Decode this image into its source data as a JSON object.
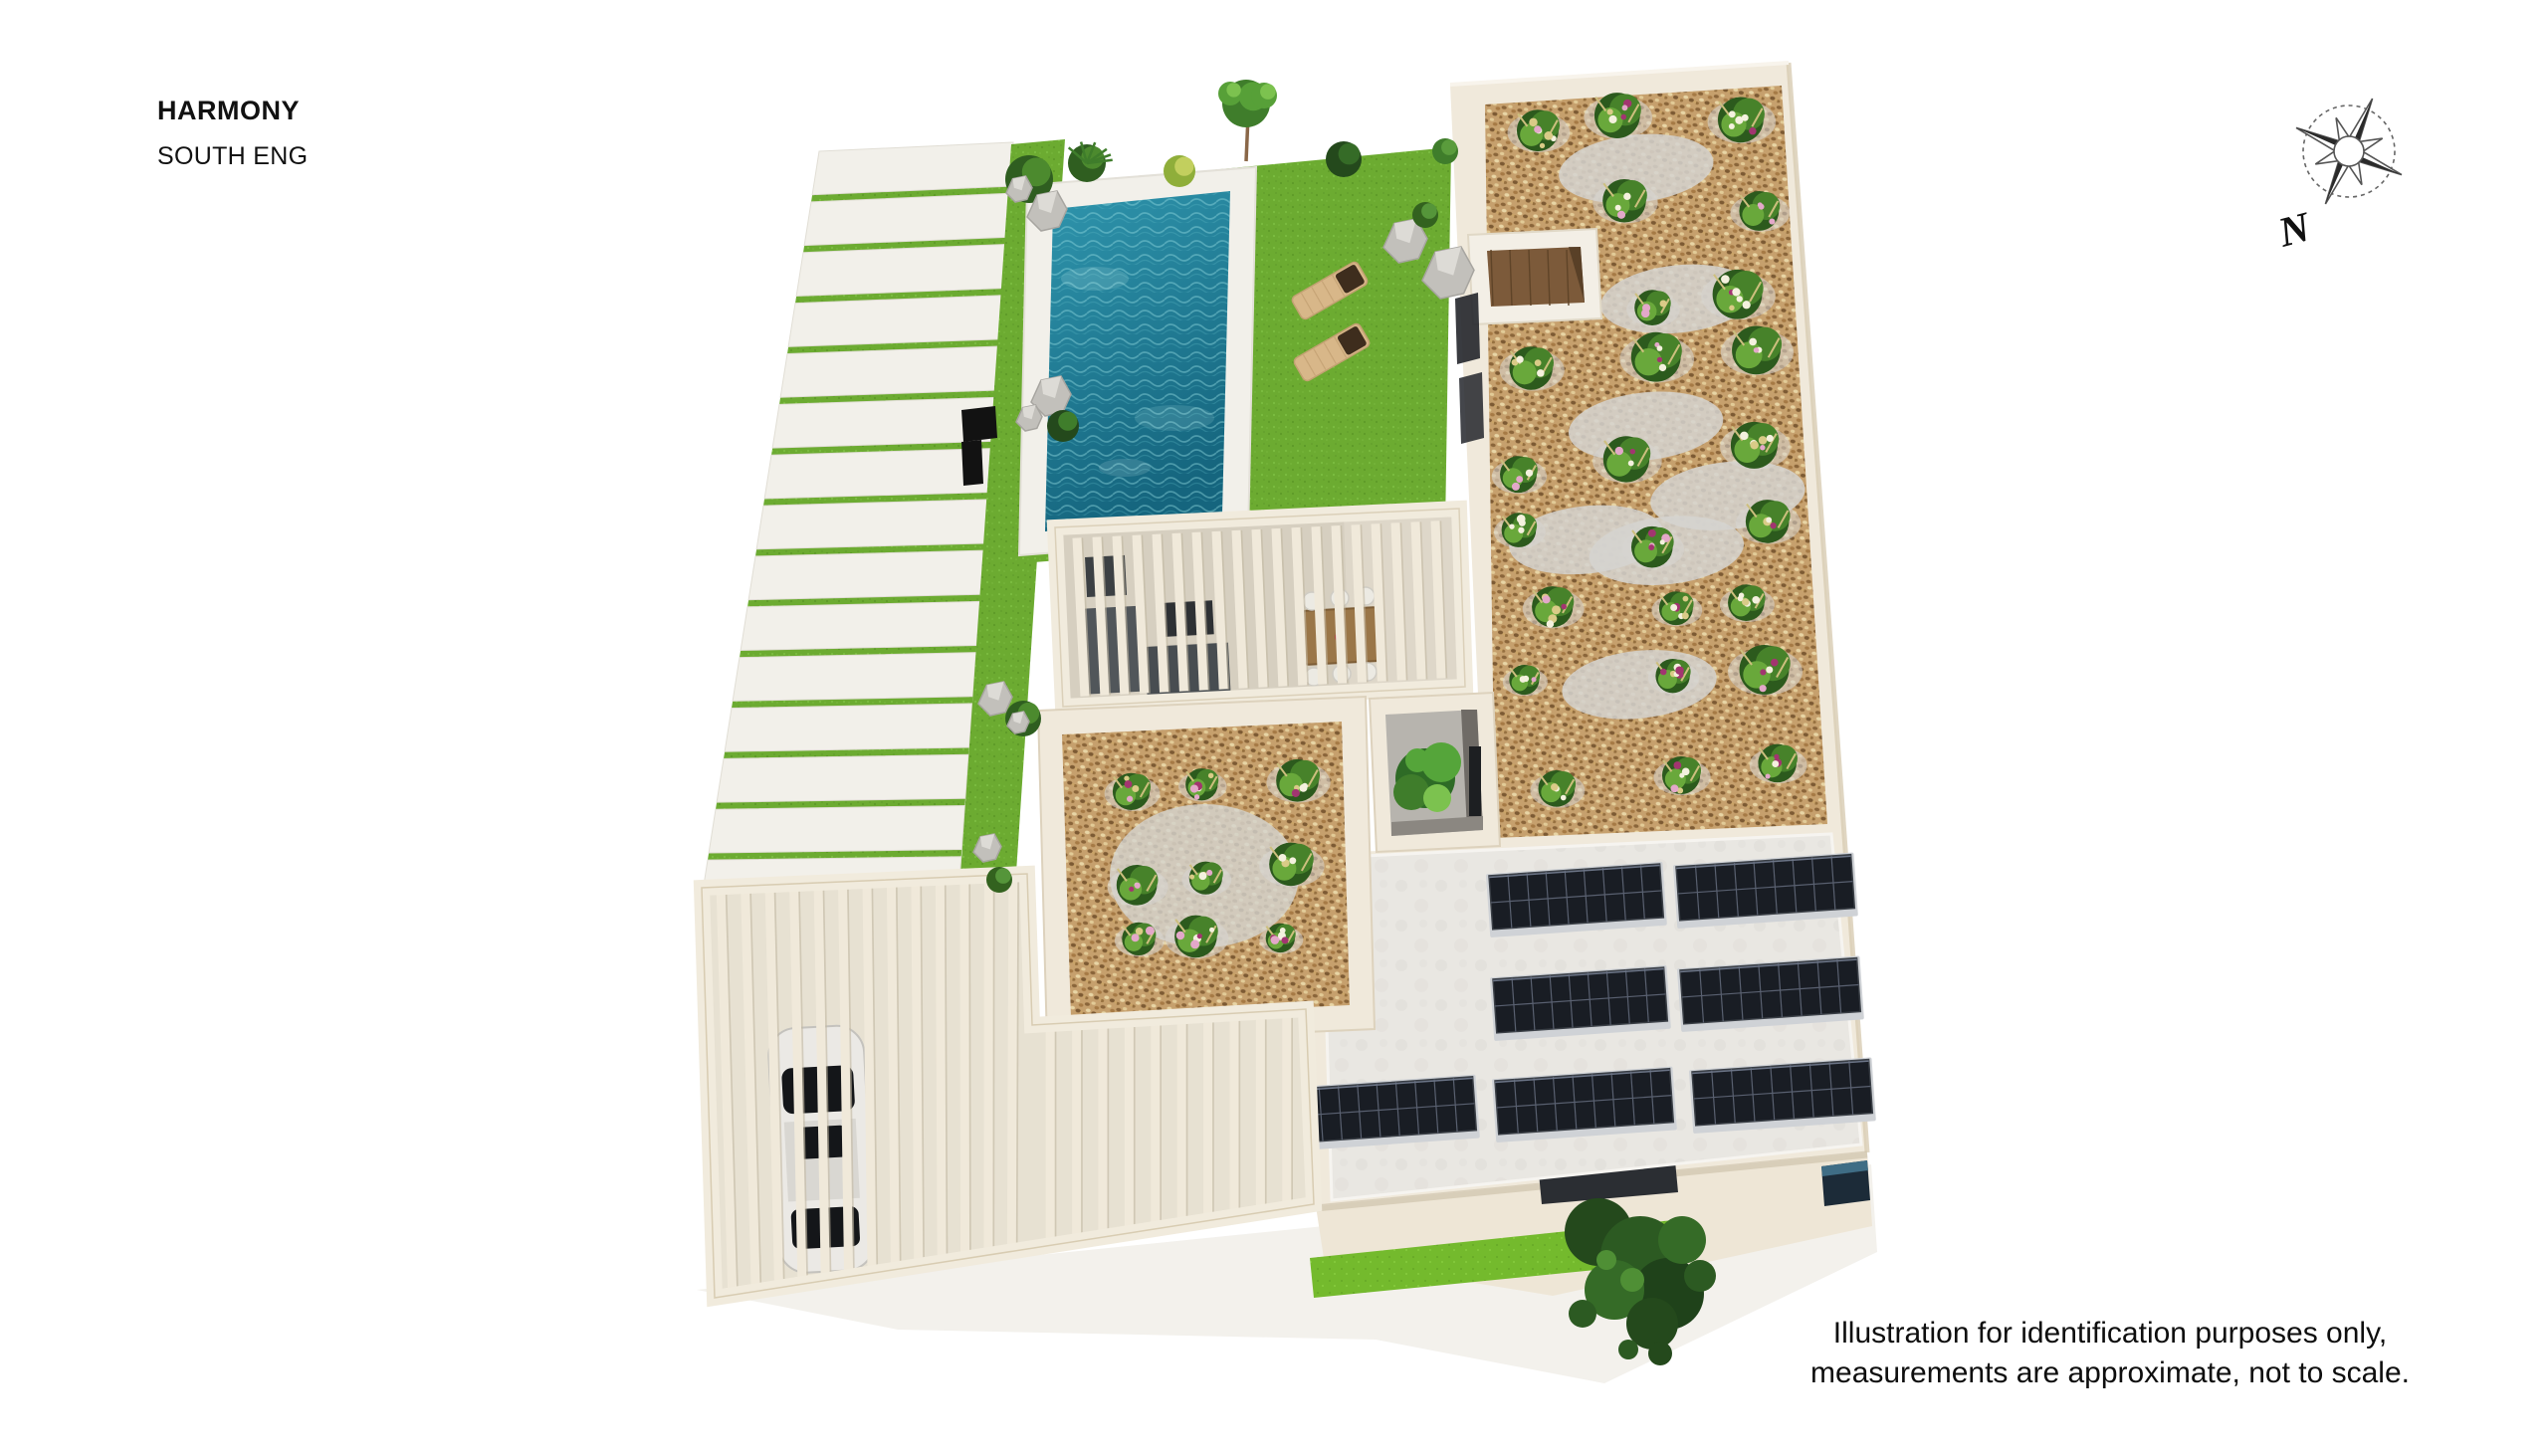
{
  "header": {
    "title": "HARMONY",
    "subtitle": "SOUTH ENG"
  },
  "compass": {
    "label": "N"
  },
  "disclaimer": {
    "line1": "Illustration for identification purposes only,",
    "line2": "measurements are approximate, not to scale."
  },
  "scene": {
    "description": "Aerial 3D render of a villa plot, slightly rotated, on a white background",
    "features": [
      "paved driveway with grass joints",
      "lawn with swimming pool",
      "two wooden sun loungers with dark cushions",
      "rocks and shrubs landscaping",
      "black garden bench",
      "slatted pergola terrace with grey lounge set and wooden dining table",
      "large gravel flower garden with white and pink blooms",
      "small sunken courtyard with wooden deck",
      "inner courtyard light-well with tree",
      "flat roof with solar panels",
      "carport pergola with parked car",
      "street-side lawn strip with tree",
      "dark entrance canopy and window"
    ],
    "solar_panels": {
      "count": 7,
      "rows": [
        2,
        2,
        3
      ]
    },
    "sun_loungers": 2,
    "colors": {
      "lawn": "#6cab31",
      "lawn_bright": "#74ba2d",
      "pool_water_deep": "#15657e",
      "pool_water": "#2f95ad",
      "pool_deck": "#f2f0ea",
      "gravel": "#c6a06d",
      "cream_wall": "#f0e9db",
      "terrace_floor": "#d6cfc0",
      "roof": "#e9e7e2",
      "solar_panel": "#191d24",
      "canopy": "#2b2e33",
      "car": "#ebe9e5",
      "text": "#111111"
    }
  }
}
